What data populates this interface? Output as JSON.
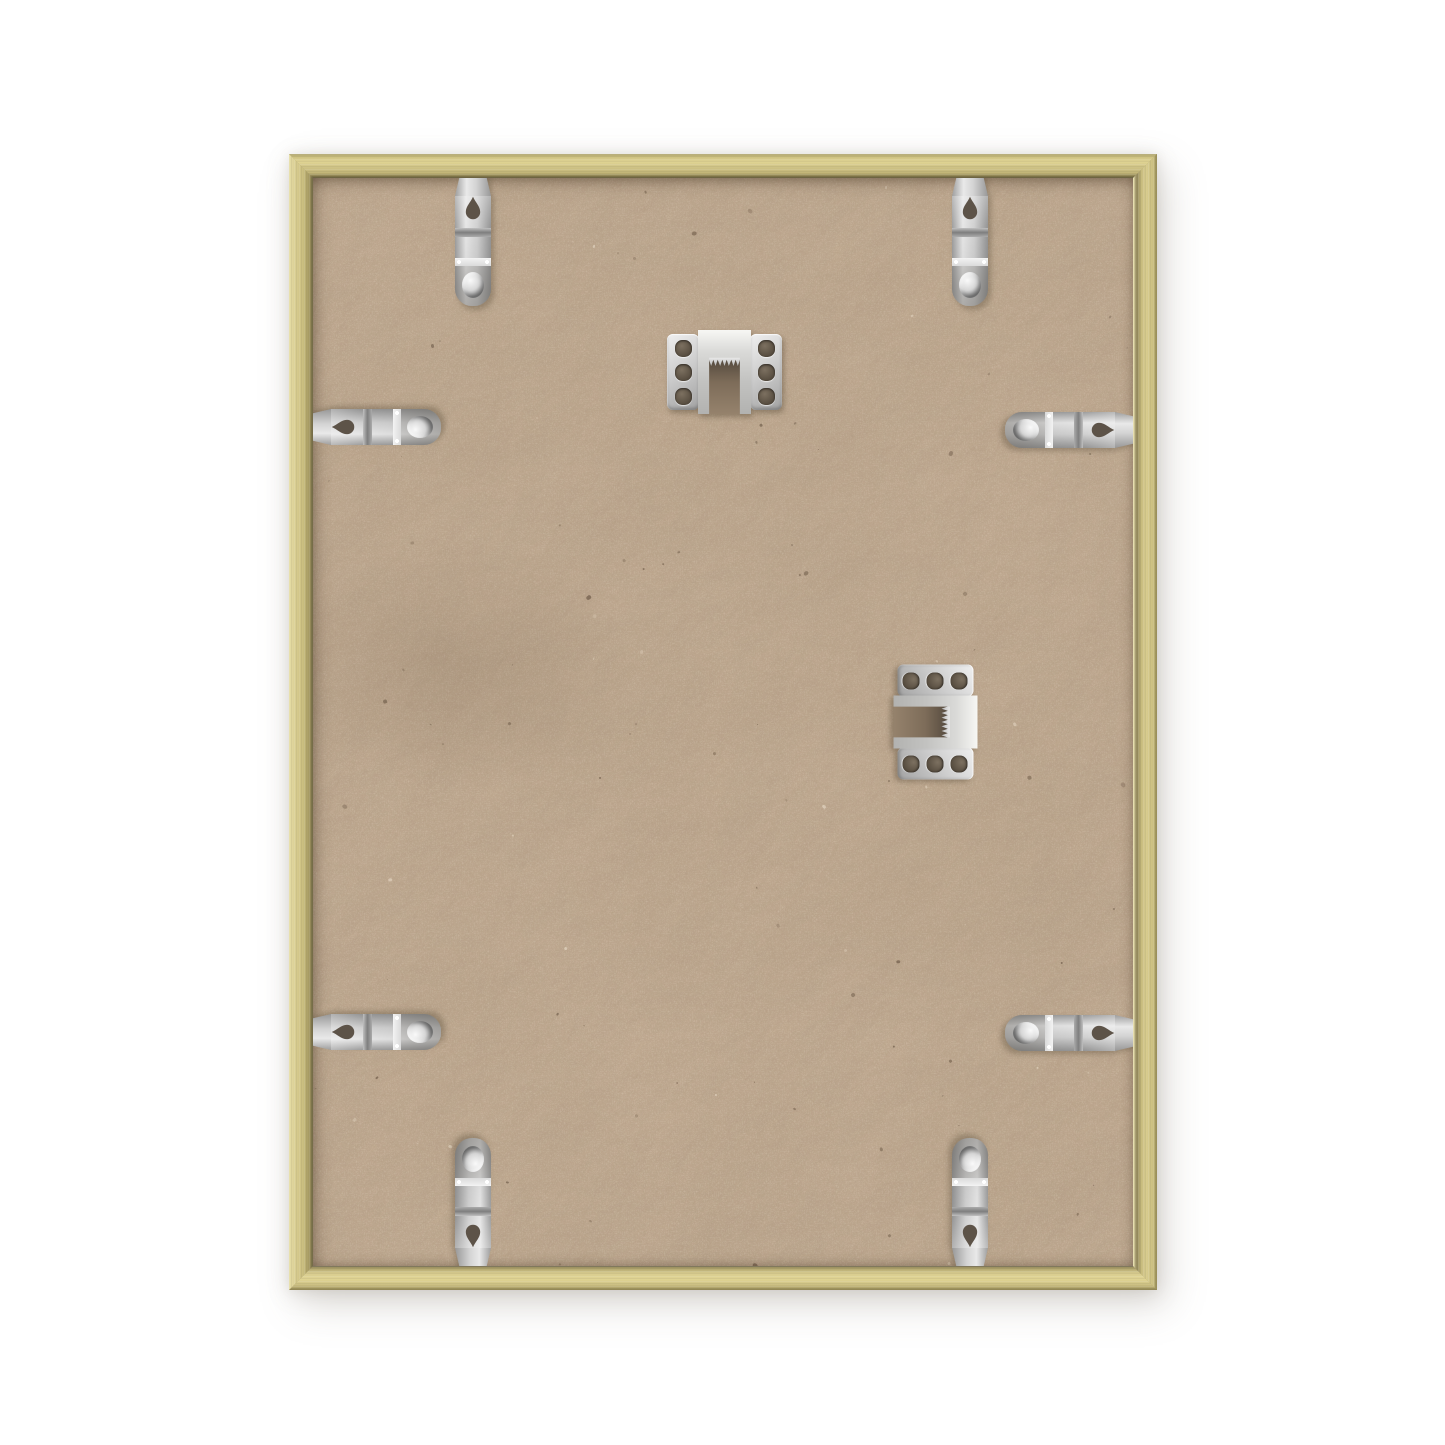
{
  "meta": {
    "type": "product-photograph",
    "subject": "Back view of an empty thin gold picture frame with MDF backing board, eight metal flex retainer tabs and two sawtooth hangers",
    "canvas": {
      "width": 1445,
      "height": 1445,
      "background": "#ffffff"
    }
  },
  "frame": {
    "name": "thin-gold-metal-frame",
    "outer": {
      "left": 289,
      "top": 154,
      "width": 868,
      "height": 1136
    },
    "profile_thickness": 24,
    "colors": {
      "gold_light": "#e4d898",
      "gold_main": "#cfc386",
      "gold_deep": "#8b8050",
      "seam_dark": "#5b543f"
    }
  },
  "backing": {
    "name": "mdf-backing-board",
    "colors": {
      "base": "#c7ae94",
      "fiber_light": "#d9c4ab",
      "speckle_dark": "#5f4f3d",
      "fleck_light": "#eddcc4"
    }
  },
  "hardware": {
    "metal_colors": {
      "light": "#efefef",
      "mid": "#cccccc",
      "dark": "#8f8f8f"
    },
    "flex_tabs": {
      "count": 8,
      "size": {
        "width": 36,
        "length": 136
      },
      "tuck_under_frame": 8,
      "items": [
        {
          "side": "top",
          "cx": 184
        },
        {
          "side": "top",
          "cx": 681
        },
        {
          "side": "left",
          "cy": 273
        },
        {
          "side": "left",
          "cy": 878
        },
        {
          "side": "right",
          "cy": 276
        },
        {
          "side": "right",
          "cy": 879
        },
        {
          "side": "bottom",
          "cx": 184
        },
        {
          "side": "bottom",
          "cx": 681
        }
      ]
    },
    "sawtooth_hangers": {
      "count": 2,
      "size": {
        "width": 115,
        "height": 84
      },
      "holes_per_wing": 3,
      "items": [
        {
          "x": 378,
          "y": 176,
          "rotation": 0
        },
        {
          "x": 589,
          "y": 526,
          "rotation": 90
        }
      ]
    }
  }
}
